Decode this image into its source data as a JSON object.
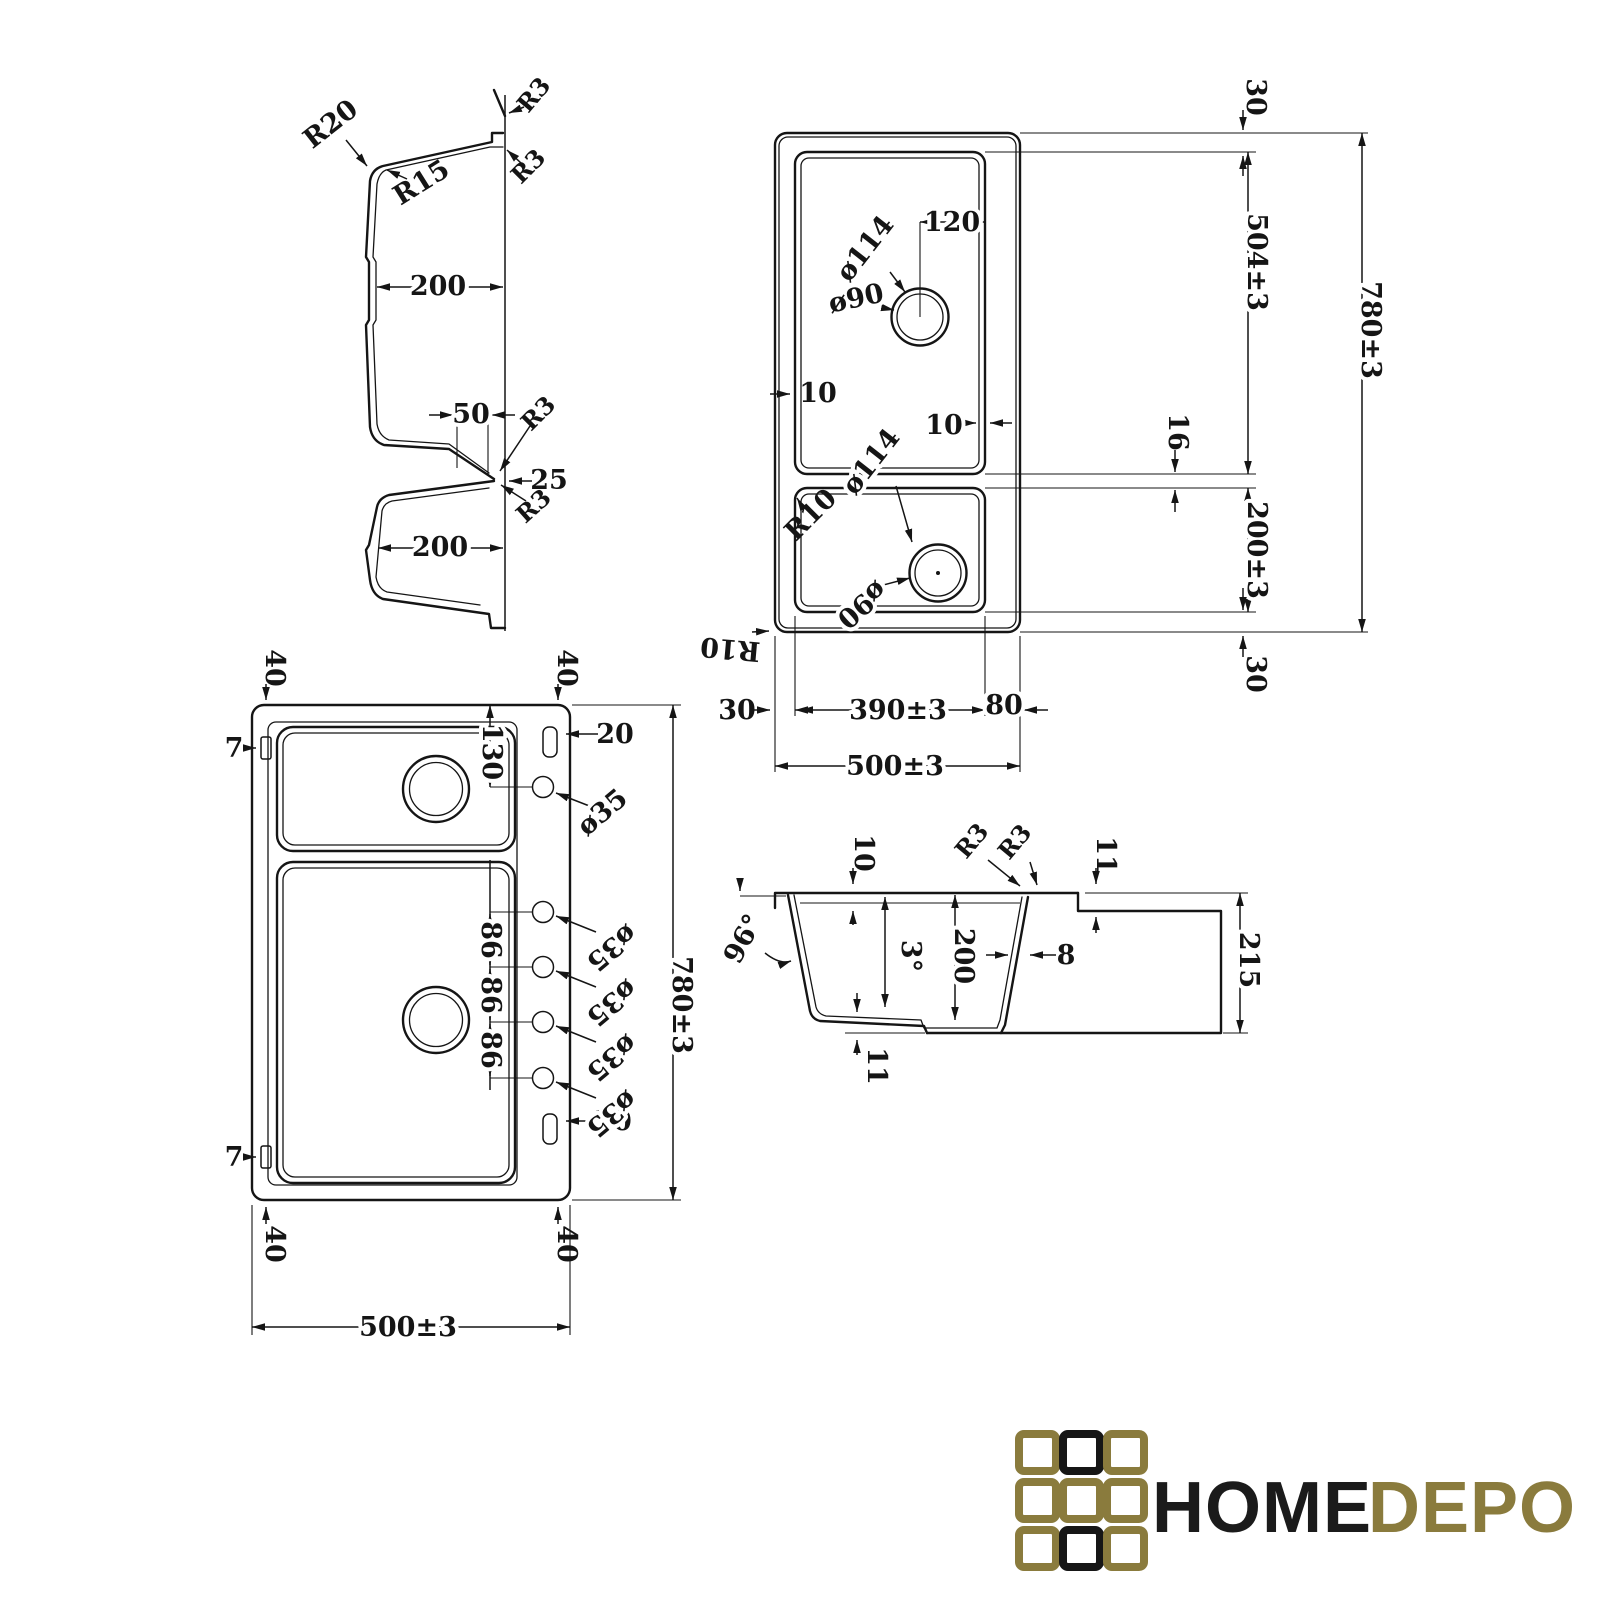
{
  "document": {
    "type": "technical-drawing",
    "subject": "double-bowl kitchen sink dimensional drawing",
    "background": "#ffffff",
    "line_color": "#151515"
  },
  "views": {
    "profile": {
      "name": "vertical cross-section through both bowls",
      "labels": {
        "r20": "R20",
        "r15": "R15",
        "r3": "R3",
        "depth": "200",
        "groove_width": "50",
        "divider_offset": "25"
      }
    },
    "plan_underside": {
      "name": "plan view with drain positions",
      "labels": {
        "margin": "30",
        "bowl1_length": "504±3",
        "overall_length": "780±3",
        "drain_offset": "120",
        "drain_outer": "ø114",
        "drain_inner": "ø90",
        "wall": "10",
        "divider": "16",
        "corner_radius": "R10",
        "bowl2_length": "200±3",
        "bowl_width": "390±3",
        "deck_width": "80",
        "overall_width": "500±3"
      }
    },
    "plan_top": {
      "name": "plan view with tap holes",
      "labels": {
        "corner": "40",
        "clip": "7",
        "slot": "20",
        "tap_offset": "130",
        "tap_diameter": "ø35",
        "tap_pitch": "86",
        "overall_length": "780±3",
        "overall_width": "500±3"
      }
    },
    "section": {
      "name": "transverse bowl section",
      "labels": {
        "reveal": "10",
        "corner_radius": "R3",
        "ledge": "11",
        "wall_angle": "96°",
        "draft_angle": "3°",
        "depth": "200",
        "wall_thickness": "8",
        "overall_height": "215",
        "bottom_thickness": "11"
      }
    }
  },
  "logo": {
    "home": "HOME",
    "depo": "DEPO",
    "home_color": "#1b1b1b",
    "depo_color": "#8a7b3d",
    "grid": [
      [
        "#8a7b3d",
        "#161616",
        "#8a7b3d"
      ],
      [
        "#8a7b3d",
        "#8a7b3d",
        "#8a7b3d"
      ],
      [
        "#8a7b3d",
        "#161616",
        "#8a7b3d"
      ]
    ]
  }
}
